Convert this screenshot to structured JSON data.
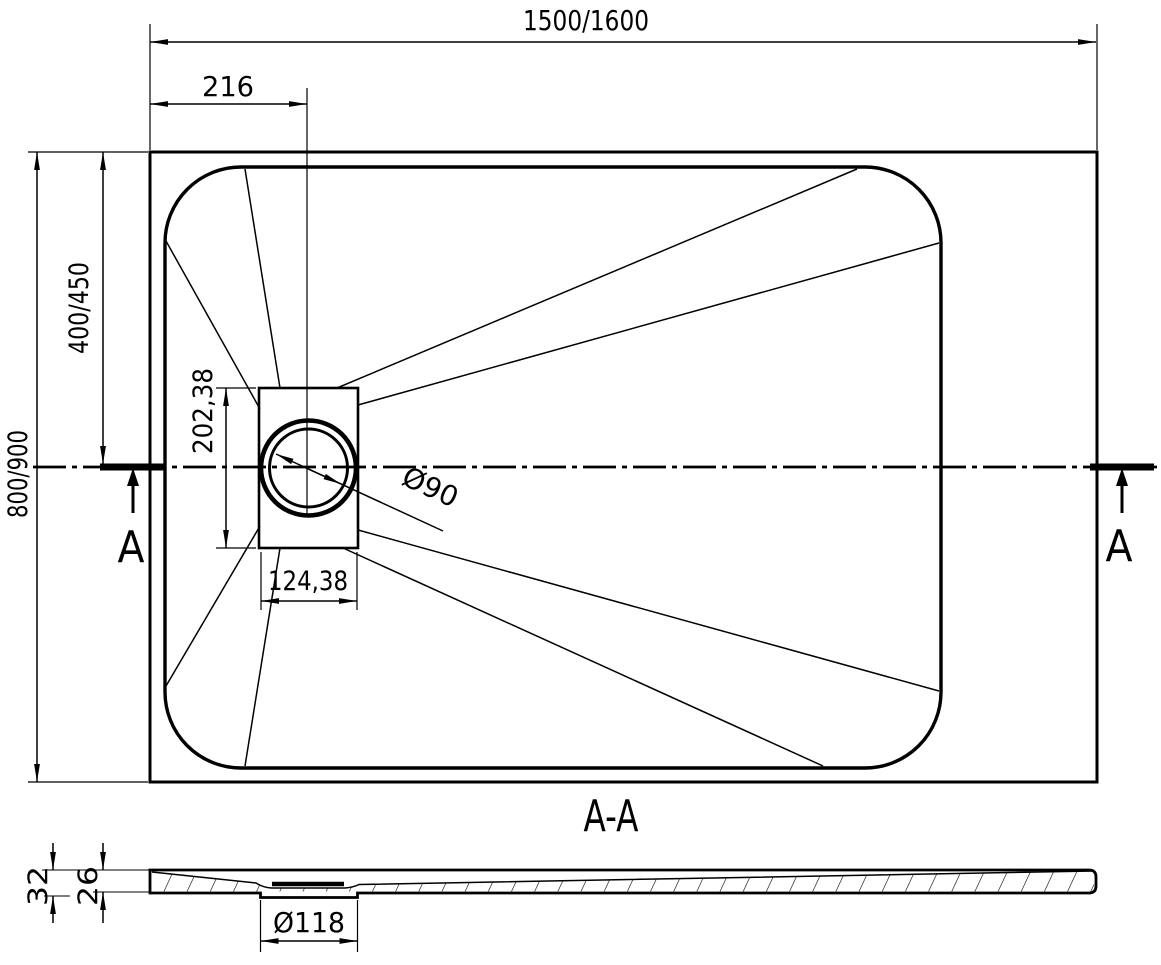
{
  "plan": {
    "overall_width": "1500/1600",
    "drain_offset_x": "216",
    "overall_depth": "800/900",
    "drain_center_y": "400/450",
    "drain_box_height": "202,38",
    "drain_box_width": "124,38",
    "drain_diameter": "Ø90",
    "section_marker_left": "A",
    "section_marker_right": "A"
  },
  "section": {
    "title": "A-A",
    "total_height": "32",
    "rim_height": "26",
    "drain_hole_diameter": "Ø118"
  },
  "colors": {
    "line": "#000000",
    "background": "#ffffff"
  }
}
